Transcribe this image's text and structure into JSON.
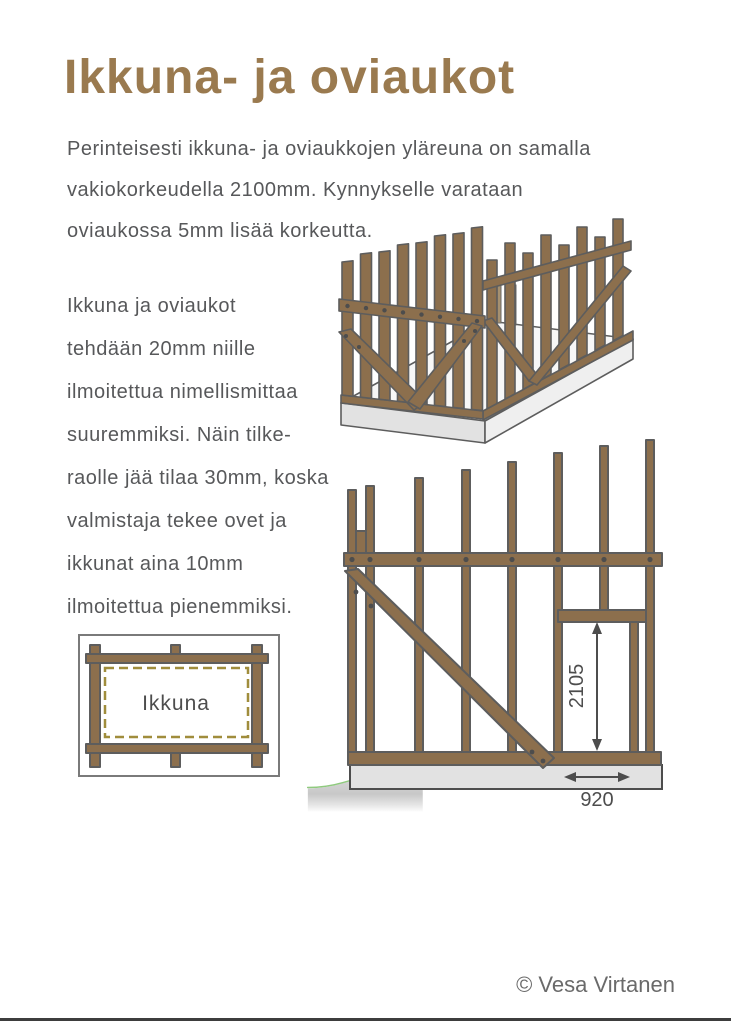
{
  "page": {
    "title": "Ikkuna- ja oviaukot",
    "copyright": "© Vesa Virtanen"
  },
  "intro_paragraph": {
    "lines": [
      "Perinteisesti ikkuna- ja oviaukkojen yläreuna on samalla",
      "vakiokorkeudella 2100mm. Kynnykselle varataan",
      "oviaukossa 5mm lisää korkeutta."
    ]
  },
  "body_paragraph": {
    "lines": [
      "Ikkuna ja oviaukot",
      "tehdään 20mm niille",
      "ilmoitettua nimellismittaa",
      "suuremmiksi. Näin tilke-",
      "raolle jää tilaa 30mm, koska",
      "valmistaja tekee ovet ja",
      "ikkunat aina 10mm",
      "ilmoitettua pienemmiksi."
    ]
  },
  "window_diagram": {
    "label": "Ikkuna"
  },
  "elevation_diagram": {
    "door_height_label": "2105",
    "door_width_label": "920"
  },
  "colors": {
    "title_brown": "#9a7a4f",
    "body_text": "#57585a",
    "wood": "#8c6f4d",
    "wood_outline": "#5d5d5d",
    "dashed_opening": "#a08d3c",
    "grass_green": "#8fca7e",
    "foundation_gray": "#e2e2e2",
    "copyright_gray": "#6a6a6a"
  }
}
